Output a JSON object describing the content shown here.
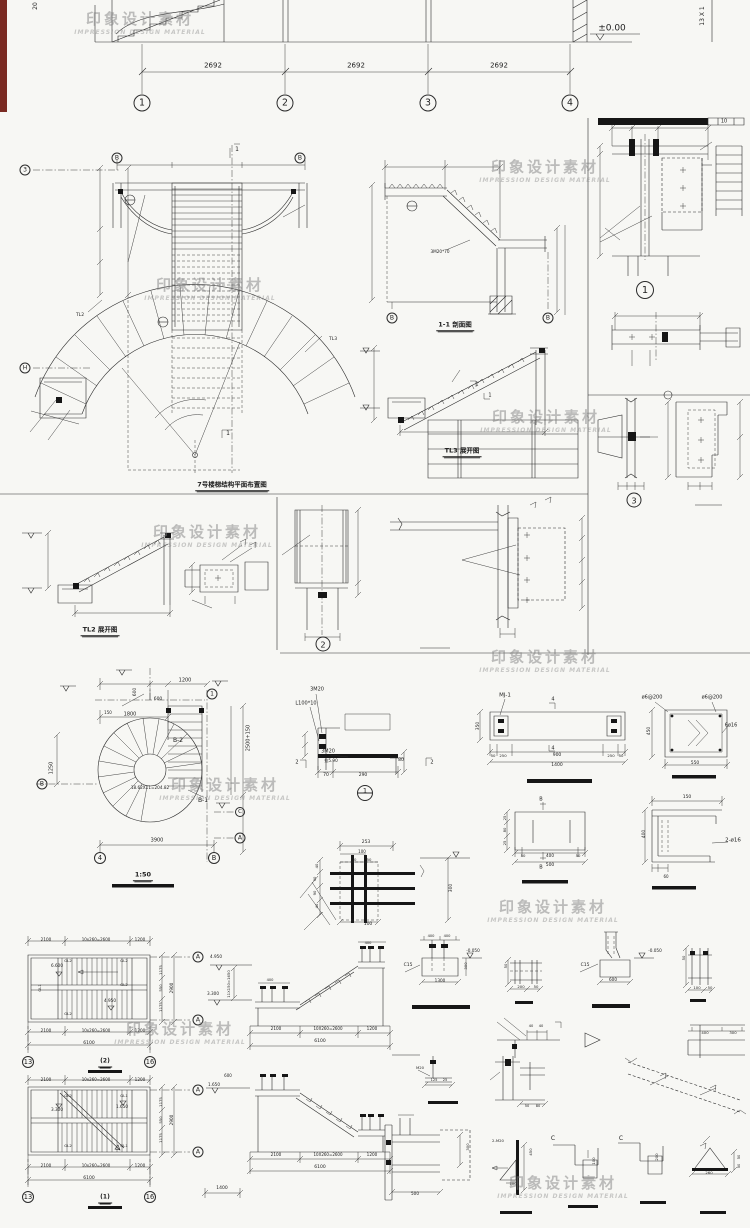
{
  "sheet": {
    "background": "#f7f7f4",
    "line_color": "#2b2b2b",
    "accent_red": "#7a2a22"
  },
  "watermark": {
    "cn": "印象设计素材",
    "en": "IMPRESSION DESIGN MATERIAL",
    "positions": [
      [
        140,
        22
      ],
      [
        210,
        288
      ],
      [
        545,
        170
      ],
      [
        546,
        420
      ],
      [
        207,
        535
      ],
      [
        225,
        788
      ],
      [
        545,
        660
      ],
      [
        553,
        910
      ],
      [
        180,
        1032
      ],
      [
        563,
        1186
      ]
    ]
  },
  "captions": [
    {
      "t": "7号楼梯结构平面布置图",
      "x": 232,
      "y": 486,
      "s": 6.5
    },
    {
      "t": "1-1 剖面图",
      "x": 455,
      "y": 326,
      "s": 6.5
    },
    {
      "t": "TL3 展开图",
      "x": 462,
      "y": 452,
      "s": 6.5
    },
    {
      "t": "TL2 展开图",
      "x": 100,
      "y": 631,
      "s": 6.5
    },
    {
      "t": "1:50",
      "x": 143,
      "y": 876,
      "s": 6.5
    },
    {
      "t": "(2)",
      "x": 105,
      "y": 1063,
      "s": 6
    },
    {
      "t": "(1)",
      "x": 105,
      "y": 1199,
      "s": 6
    }
  ],
  "grid_bubbles": [
    {
      "t": "1",
      "x": 142,
      "y": 103,
      "d": 17
    },
    {
      "t": "2",
      "x": 285,
      "y": 103,
      "d": 17
    },
    {
      "t": "3",
      "x": 428,
      "y": 103,
      "d": 17
    },
    {
      "t": "4",
      "x": 570,
      "y": 103,
      "d": 17
    },
    {
      "t": "B",
      "x": 117,
      "y": 158,
      "d": 11
    },
    {
      "t": "B",
      "x": 300,
      "y": 158,
      "d": 11
    },
    {
      "t": "3",
      "x": 25,
      "y": 170,
      "d": 11
    },
    {
      "t": "H",
      "x": 25,
      "y": 368,
      "d": 11
    },
    {
      "t": "B",
      "x": 392,
      "y": 318,
      "d": 11
    },
    {
      "t": "B",
      "x": 548,
      "y": 318,
      "d": 11
    },
    {
      "t": "1",
      "x": 212,
      "y": 694,
      "d": 11
    },
    {
      "t": "B",
      "x": 42,
      "y": 784,
      "d": 11
    },
    {
      "t": "4",
      "x": 100,
      "y": 858,
      "d": 12
    },
    {
      "t": "B",
      "x": 214,
      "y": 858,
      "d": 12
    },
    {
      "t": "C",
      "x": 240,
      "y": 812,
      "d": 10
    },
    {
      "t": "A",
      "x": 240,
      "y": 838,
      "d": 11
    },
    {
      "t": "A",
      "x": 198,
      "y": 957,
      "d": 11
    },
    {
      "t": "A",
      "x": 198,
      "y": 1020,
      "d": 11
    },
    {
      "t": "13",
      "x": 28,
      "y": 1062,
      "d": 12
    },
    {
      "t": "16",
      "x": 150,
      "y": 1062,
      "d": 12
    },
    {
      "t": "A",
      "x": 198,
      "y": 1090,
      "d": 11
    },
    {
      "t": "A",
      "x": 198,
      "y": 1152,
      "d": 11
    },
    {
      "t": "13",
      "x": 28,
      "y": 1197,
      "d": 12
    },
    {
      "t": "16",
      "x": 150,
      "y": 1197,
      "d": 12
    }
  ],
  "detail_bubbles": [
    {
      "t": "1",
      "x": 645,
      "y": 290,
      "d": 18,
      "split": false
    },
    {
      "t": "3",
      "x": 634,
      "y": 500,
      "d": 15,
      "split": false
    },
    {
      "t": "2",
      "x": 323,
      "y": 644,
      "d": 15,
      "split": false
    },
    {
      "t": "1",
      "x": 365,
      "y": 793,
      "d": 16,
      "split": true
    }
  ],
  "labels": [
    {
      "t": "2692",
      "x": 213,
      "y": 66,
      "s": 7
    },
    {
      "t": "2692",
      "x": 356,
      "y": 66,
      "s": 7
    },
    {
      "t": "2692",
      "x": 499,
      "y": 66,
      "s": 7
    },
    {
      "t": "±0.00",
      "x": 612,
      "y": 29,
      "s": 9
    },
    {
      "t": "13 X 1",
      "x": 703,
      "y": 16,
      "r": -90,
      "s": 6
    },
    {
      "t": "20",
      "x": 36,
      "y": 6,
      "r": -90,
      "s": 6
    },
    {
      "t": "10",
      "x": 724,
      "y": 122,
      "s": 5
    },
    {
      "t": "1",
      "x": 237,
      "y": 150,
      "s": 6
    },
    {
      "t": "1",
      "x": 228,
      "y": 434,
      "s": 6
    },
    {
      "t": "TL3",
      "x": 333,
      "y": 340,
      "s": 4.5
    },
    {
      "t": "TL2",
      "x": 80,
      "y": 316,
      "s": 4.5
    },
    {
      "t": "3M20*70",
      "x": 440,
      "y": 252,
      "s": 4.2
    },
    {
      "t": "1",
      "x": 477,
      "y": 385,
      "s": 5
    },
    {
      "t": "1",
      "x": 490,
      "y": 396,
      "s": 5
    },
    {
      "t": "B-2",
      "x": 178,
      "y": 741,
      "s": 6
    },
    {
      "t": "B-1",
      "x": 203,
      "y": 801,
      "s": 6
    },
    {
      "t": "18.62X11=204.82",
      "x": 150,
      "y": 788,
      "s": 4.2
    },
    {
      "t": "1200",
      "x": 185,
      "y": 681,
      "s": 5
    },
    {
      "t": "600",
      "x": 158,
      "y": 700,
      "s": 4.5
    },
    {
      "t": "600",
      "x": 136,
      "y": 692,
      "r": -90,
      "s": 4.5
    },
    {
      "t": "1800",
      "x": 130,
      "y": 715,
      "s": 5
    },
    {
      "t": "150",
      "x": 108,
      "y": 713,
      "s": 4
    },
    {
      "t": "1250",
      "x": 52,
      "y": 768,
      "r": -90,
      "s": 5
    },
    {
      "t": "2500+150",
      "x": 249,
      "y": 738,
      "r": -90,
      "s": 5
    },
    {
      "t": "3900",
      "x": 157,
      "y": 841,
      "s": 5
    },
    {
      "t": "3M20",
      "x": 317,
      "y": 690,
      "s": 5
    },
    {
      "t": "L100*10",
      "x": 306,
      "y": 704,
      "s": 5
    },
    {
      "t": "3M20",
      "x": 328,
      "y": 752,
      "s": 5
    },
    {
      "t": "拉5.90",
      "x": 331,
      "y": 761,
      "s": 4.2
    },
    {
      "t": "70",
      "x": 326,
      "y": 776,
      "s": 4.5
    },
    {
      "t": "290",
      "x": 363,
      "y": 776,
      "s": 4.5
    },
    {
      "t": "80",
      "x": 401,
      "y": 761,
      "s": 4.5
    },
    {
      "t": "2",
      "x": 297,
      "y": 763,
      "s": 5
    },
    {
      "t": "2",
      "x": 432,
      "y": 763,
      "s": 5
    },
    {
      "t": "253",
      "x": 366,
      "y": 843,
      "s": 4.5
    },
    {
      "t": "100",
      "x": 362,
      "y": 852,
      "s": 4
    },
    {
      "t": "50",
      "x": 354,
      "y": 860,
      "s": 3.8
    },
    {
      "t": "50",
      "x": 369,
      "y": 860,
      "s": 3.8
    },
    {
      "t": "300",
      "x": 452,
      "y": 888,
      "r": -90,
      "s": 4.5
    },
    {
      "t": "100",
      "x": 368,
      "y": 925,
      "s": 4.5
    },
    {
      "t": "40",
      "x": 317,
      "y": 866,
      "r": -90,
      "s": 3.8
    },
    {
      "t": "90",
      "x": 315,
      "y": 879,
      "r": -90,
      "s": 3.8
    },
    {
      "t": "90",
      "x": 315,
      "y": 893,
      "r": -90,
      "s": 3.8
    },
    {
      "t": "40",
      "x": 317,
      "y": 906,
      "r": -90,
      "s": 3.8
    },
    {
      "t": "MJ-1",
      "x": 505,
      "y": 696,
      "s": 5.5
    },
    {
      "t": "4",
      "x": 553,
      "y": 700,
      "s": 5
    },
    {
      "t": "4",
      "x": 553,
      "y": 749,
      "s": 5
    },
    {
      "t": "350",
      "x": 479,
      "y": 726,
      "r": -90,
      "s": 4.5
    },
    {
      "t": "50",
      "x": 493,
      "y": 756,
      "s": 3.8
    },
    {
      "t": "250",
      "x": 503,
      "y": 756,
      "s": 3.8
    },
    {
      "t": "900",
      "x": 557,
      "y": 756,
      "s": 4.5
    },
    {
      "t": "250",
      "x": 611,
      "y": 756,
      "s": 3.8
    },
    {
      "t": "50",
      "x": 621,
      "y": 756,
      "s": 3.8
    },
    {
      "t": "1400",
      "x": 557,
      "y": 766,
      "s": 4.5
    },
    {
      "t": "ø6@200",
      "x": 652,
      "y": 698,
      "s": 5
    },
    {
      "t": "ø6@200",
      "x": 712,
      "y": 698,
      "s": 5
    },
    {
      "t": "6ø16",
      "x": 731,
      "y": 726,
      "s": 5
    },
    {
      "t": "450",
      "x": 650,
      "y": 731,
      "r": -90,
      "s": 4.5
    },
    {
      "t": "550",
      "x": 695,
      "y": 764,
      "s": 4.5
    },
    {
      "t": "25",
      "x": 505,
      "y": 818,
      "r": -90,
      "s": 3.8
    },
    {
      "t": "80",
      "x": 505,
      "y": 830,
      "r": -90,
      "s": 3.8
    },
    {
      "t": "25",
      "x": 505,
      "y": 843,
      "r": -90,
      "s": 3.8
    },
    {
      "t": "B",
      "x": 541,
      "y": 800,
      "s": 5
    },
    {
      "t": "B",
      "x": 541,
      "y": 868,
      "s": 5
    },
    {
      "t": "50",
      "x": 523,
      "y": 856,
      "s": 3.8
    },
    {
      "t": "400",
      "x": 550,
      "y": 856,
      "s": 4.2
    },
    {
      "t": "50",
      "x": 578,
      "y": 856,
      "s": 3.8
    },
    {
      "t": "500",
      "x": 550,
      "y": 866,
      "s": 4.5
    },
    {
      "t": "150",
      "x": 687,
      "y": 798,
      "s": 4.5
    },
    {
      "t": "400",
      "x": 645,
      "y": 834,
      "r": -90,
      "s": 4.5
    },
    {
      "t": "2-ø16",
      "x": 733,
      "y": 841,
      "s": 5.5
    },
    {
      "t": "60",
      "x": 666,
      "y": 877,
      "s": 4
    },
    {
      "t": "2100",
      "x": 46,
      "y": 940,
      "s": 4.2
    },
    {
      "t": "10x260=2600",
      "x": 96,
      "y": 940,
      "s": 4
    },
    {
      "t": "1200",
      "x": 140,
      "y": 940,
      "s": 4.2
    },
    {
      "t": "2100",
      "x": 46,
      "y": 1031,
      "s": 4.2
    },
    {
      "t": "10x260=2600",
      "x": 96,
      "y": 1031,
      "s": 4
    },
    {
      "t": "1200",
      "x": 140,
      "y": 1031,
      "s": 4.2
    },
    {
      "t": "6100",
      "x": 89,
      "y": 1044,
      "s": 4.5
    },
    {
      "t": "1175",
      "x": 161,
      "y": 970,
      "r": -90,
      "s": 3.8
    },
    {
      "t": "550",
      "x": 161,
      "y": 988,
      "r": -90,
      "s": 3.8
    },
    {
      "t": "1175",
      "x": 161,
      "y": 1007,
      "r": -90,
      "s": 3.8
    },
    {
      "t": "2900",
      "x": 172,
      "y": 988,
      "r": -90,
      "s": 4.2
    },
    {
      "t": "6.600",
      "x": 57,
      "y": 966,
      "s": 4.2
    },
    {
      "t": "4.950",
      "x": 110,
      "y": 1001,
      "s": 4.2
    },
    {
      "t": "GL2",
      "x": 68,
      "y": 961,
      "s": 3.8
    },
    {
      "t": "GL2",
      "x": 124,
      "y": 961,
      "s": 3.8
    },
    {
      "t": "GL2",
      "x": 124,
      "y": 985,
      "s": 3.8
    },
    {
      "t": "GL2",
      "x": 68,
      "y": 1014,
      "s": 3.8
    },
    {
      "t": "GL1",
      "x": 40,
      "y": 988,
      "r": -90,
      "s": 3.8
    },
    {
      "t": "2100",
      "x": 46,
      "y": 1080,
      "s": 4.2
    },
    {
      "t": "10x260=2600",
      "x": 96,
      "y": 1080,
      "s": 4
    },
    {
      "t": "1200",
      "x": 140,
      "y": 1080,
      "s": 4.2
    },
    {
      "t": "2100",
      "x": 46,
      "y": 1166,
      "s": 4.2
    },
    {
      "t": "10x260=2600",
      "x": 96,
      "y": 1166,
      "s": 4
    },
    {
      "t": "1200",
      "x": 140,
      "y": 1166,
      "s": 4.2
    },
    {
      "t": "6100",
      "x": 89,
      "y": 1179,
      "s": 4.5
    },
    {
      "t": "1175",
      "x": 161,
      "y": 1102,
      "r": -90,
      "s": 3.8
    },
    {
      "t": "550",
      "x": 161,
      "y": 1120,
      "r": -90,
      "s": 3.8
    },
    {
      "t": "1175",
      "x": 161,
      "y": 1138,
      "r": -90,
      "s": 3.8
    },
    {
      "t": "2900",
      "x": 172,
      "y": 1120,
      "r": -90,
      "s": 4.2
    },
    {
      "t": "3.300",
      "x": 57,
      "y": 1110,
      "s": 4.2
    },
    {
      "t": "1.650",
      "x": 122,
      "y": 1107,
      "s": 4.2
    },
    {
      "t": "GL2",
      "x": 68,
      "y": 1096,
      "s": 3.8
    },
    {
      "t": "GL1",
      "x": 124,
      "y": 1096,
      "s": 3.8
    },
    {
      "t": "GL2",
      "x": 68,
      "y": 1146,
      "s": 3.8
    },
    {
      "t": "GL1",
      "x": 124,
      "y": 1146,
      "s": 3.8
    },
    {
      "t": "4.950",
      "x": 216,
      "y": 957,
      "s": 4.2
    },
    {
      "t": "3.300",
      "x": 213,
      "y": 994,
      "s": 4.2
    },
    {
      "t": "11X150=1650",
      "x": 229,
      "y": 984,
      "r": -90,
      "s": 3.8
    },
    {
      "t": "2100",
      "x": 276,
      "y": 1029,
      "s": 4.2
    },
    {
      "t": "10X260=2600",
      "x": 328,
      "y": 1029,
      "s": 4
    },
    {
      "t": "1200",
      "x": 372,
      "y": 1029,
      "s": 4.2
    },
    {
      "t": "6100",
      "x": 320,
      "y": 1042,
      "s": 4.5
    },
    {
      "t": "400",
      "x": 270,
      "y": 981,
      "s": 3.6
    },
    {
      "t": "400",
      "x": 368,
      "y": 944,
      "s": 3.6
    },
    {
      "t": "600",
      "x": 228,
      "y": 1076,
      "s": 4
    },
    {
      "t": "1.650",
      "x": 214,
      "y": 1085,
      "s": 4.2
    },
    {
      "t": "2100",
      "x": 276,
      "y": 1155,
      "s": 4.2
    },
    {
      "t": "10X260=2600",
      "x": 328,
      "y": 1155,
      "s": 4
    },
    {
      "t": "1200",
      "x": 372,
      "y": 1155,
      "s": 4.2
    },
    {
      "t": "6100",
      "x": 320,
      "y": 1168,
      "s": 4.5
    },
    {
      "t": "1400",
      "x": 222,
      "y": 1189,
      "s": 4.5
    },
    {
      "t": "-0.050",
      "x": 473,
      "y": 951,
      "s": 4.2
    },
    {
      "t": "C15",
      "x": 408,
      "y": 966,
      "s": 4.5
    },
    {
      "t": "1300",
      "x": 440,
      "y": 981,
      "s": 4.2
    },
    {
      "t": "300",
      "x": 466,
      "y": 966,
      "r": -90,
      "s": 3.8
    },
    {
      "t": "400",
      "x": 431,
      "y": 937,
      "s": 3.6
    },
    {
      "t": "400",
      "x": 447,
      "y": 937,
      "s": 3.6
    },
    {
      "t": "200",
      "x": 521,
      "y": 987,
      "s": 3.8
    },
    {
      "t": "50",
      "x": 536,
      "y": 987,
      "s": 3.8
    },
    {
      "t": "50",
      "x": 506,
      "y": 966,
      "r": -90,
      "s": 3.8
    },
    {
      "t": "-0.050",
      "x": 655,
      "y": 951,
      "s": 4.2
    },
    {
      "t": "C15",
      "x": 585,
      "y": 966,
      "s": 4.5
    },
    {
      "t": "600",
      "x": 613,
      "y": 980,
      "s": 4.2
    },
    {
      "t": "100",
      "x": 697,
      "y": 988,
      "s": 3.8
    },
    {
      "t": "50",
      "x": 710,
      "y": 988,
      "s": 3.8
    },
    {
      "t": "50",
      "x": 684,
      "y": 958,
      "r": -90,
      "s": 3.8
    },
    {
      "t": "40",
      "x": 531,
      "y": 1027,
      "s": 3.6
    },
    {
      "t": "40",
      "x": 541,
      "y": 1027,
      "s": 3.6
    },
    {
      "t": "400",
      "x": 705,
      "y": 1033,
      "s": 3.8
    },
    {
      "t": "300",
      "x": 733,
      "y": 1033,
      "s": 3.8
    },
    {
      "t": "M20",
      "x": 420,
      "y": 1068,
      "s": 3.8
    },
    {
      "t": "125",
      "x": 434,
      "y": 1081,
      "s": 3.6
    },
    {
      "t": "25",
      "x": 445,
      "y": 1081,
      "s": 3.6
    },
    {
      "t": "50",
      "x": 527,
      "y": 1107,
      "s": 3.6
    },
    {
      "t": "80",
      "x": 538,
      "y": 1107,
      "s": 3.6
    },
    {
      "t": "500",
      "x": 415,
      "y": 1194,
      "s": 4.2
    },
    {
      "t": "300",
      "x": 468,
      "y": 1147,
      "r": -90,
      "s": 3.8
    },
    {
      "t": "2-M20",
      "x": 498,
      "y": 1141,
      "s": 3.8
    },
    {
      "t": "450",
      "x": 531,
      "y": 1152,
      "r": -90,
      "s": 3.8
    },
    {
      "t": "100",
      "x": 513,
      "y": 1184,
      "s": 3.8
    },
    {
      "t": "C",
      "x": 553,
      "y": 1139,
      "s": 6
    },
    {
      "t": "100",
      "x": 594,
      "y": 1161,
      "r": -90,
      "s": 3.8
    },
    {
      "t": "C",
      "x": 621,
      "y": 1139,
      "s": 6
    },
    {
      "t": "200",
      "x": 657,
      "y": 1157,
      "r": -90,
      "s": 3.8
    },
    {
      "t": "260",
      "x": 709,
      "y": 1173,
      "s": 3.8
    },
    {
      "t": "50",
      "x": 740,
      "y": 1157,
      "r": -90,
      "s": 3.6
    },
    {
      "t": "50",
      "x": 740,
      "y": 1166,
      "r": -90,
      "s": 3.6
    }
  ]
}
